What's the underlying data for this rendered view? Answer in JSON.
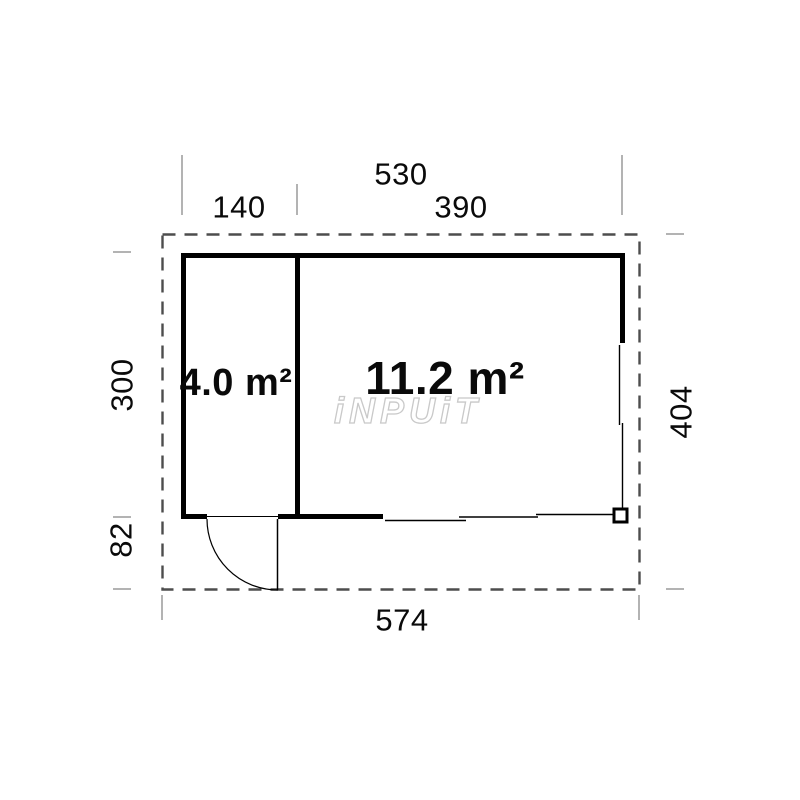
{
  "diagram": {
    "type": "floor-plan",
    "watermark": "iNPUiT",
    "rooms": [
      {
        "id": "room-small",
        "label": "4.0 m²"
      },
      {
        "id": "room-large",
        "label": "11.2 m²"
      }
    ],
    "dimensions": {
      "overall_width": "530",
      "left_section_width": "140",
      "right_section_width": "390",
      "building_depth": "300",
      "porch_depth": "82",
      "overall_depth": "404",
      "overall_length": "574"
    },
    "colors": {
      "wall": "#000000",
      "boundary_dashed": "#4d4d4d",
      "dimension_tick": "#b3b3b3",
      "watermark_outline": "#c9c9c9"
    }
  }
}
